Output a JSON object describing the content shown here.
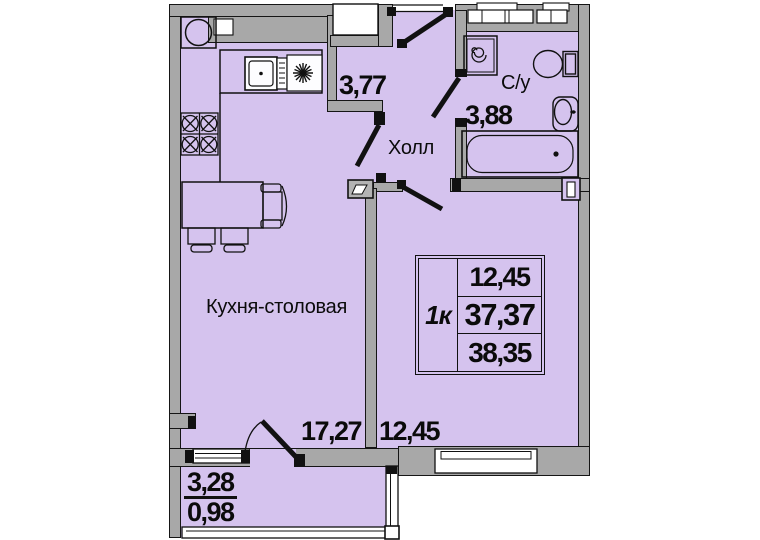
{
  "plan": {
    "rooms": {
      "kitchen": {
        "label": "Кухня-столовая",
        "dimension": "17,27"
      },
      "hall": {
        "label": "Холл",
        "dimension": "3,77"
      },
      "bathroom": {
        "label": "С/у",
        "dimension": "3,88"
      },
      "room": {
        "dimension": "12,45"
      },
      "balcony": {
        "dimension_full": "3,28",
        "dimension_reduced": "0,98"
      }
    },
    "info_box": {
      "unit_type": "1к",
      "living_area": "12,45",
      "area": "37,37",
      "total_area": "38,35"
    },
    "colors": {
      "floor": "#d5c3ee",
      "wall": "#a8a8a8",
      "outline": "#111111",
      "background": "#ffffff"
    },
    "icons": [
      "kitchen-sink-icon",
      "hob-icon",
      "oven-icon",
      "burner-star-icon",
      "dining-table-icon",
      "armchair-icon",
      "chair-icon",
      "washing-machine-icon",
      "toilet-icon",
      "bathroom-sink-icon",
      "bathtub-icon",
      "door-leaf-icon",
      "window-icon",
      "vent-duct-icon",
      "electrical-panel-icon"
    ]
  }
}
